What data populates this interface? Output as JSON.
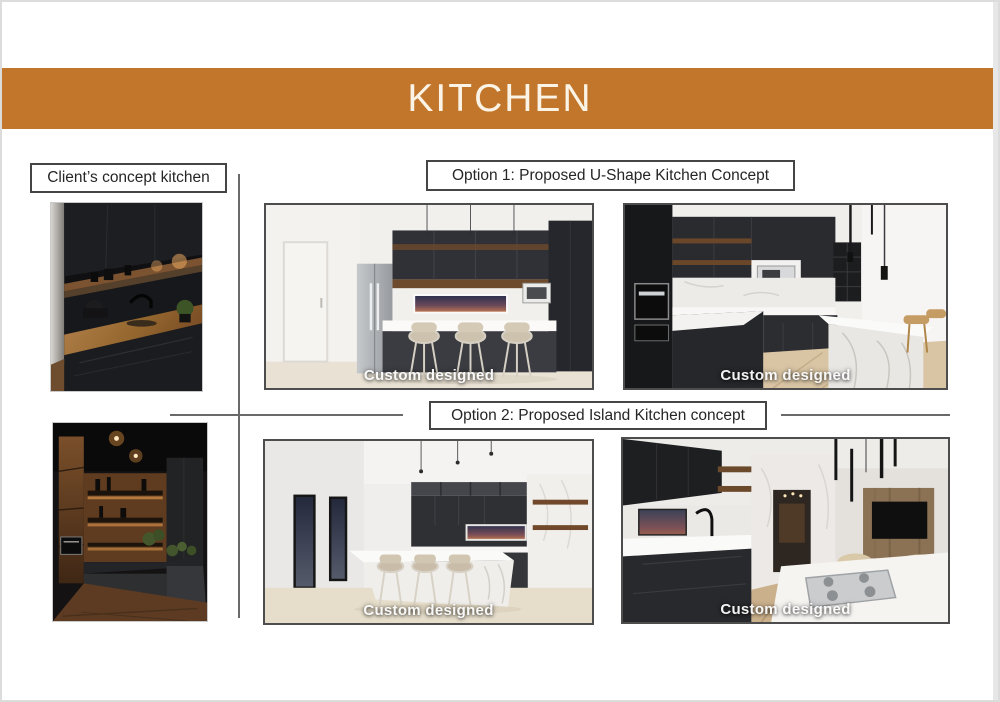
{
  "page": {
    "background": "#ffffff",
    "border_color": "#dcdcdc"
  },
  "header": {
    "title": "KITCHEN",
    "bar_color": "#c1762b",
    "text_color": "#fbf4e6"
  },
  "labels": {
    "client": "Client’s concept kitchen",
    "option1": "Option 1: Proposed U-Shape Kitchen Concept",
    "option2": "Option 2: Proposed Island Kitchen concept"
  },
  "watermark": {
    "text": "Custom designed"
  },
  "images": {
    "client_photo_1": "Dark charcoal kitchen with timber benchtop and lit timber shelf",
    "client_photo_2": "Dark kitchen with rustic timber panelling and ceiling downlights",
    "option1_render_1": "U-shape kitchen render with fridge, breakfast bar and three stools",
    "option1_render_2": "U-shape kitchen render with wall oven and marble waterfall bench",
    "option2_render_1": "Island kitchen render with long white island and three stools",
    "option2_render_2": "Island kitchen render with gas cooktop island facing living area"
  }
}
